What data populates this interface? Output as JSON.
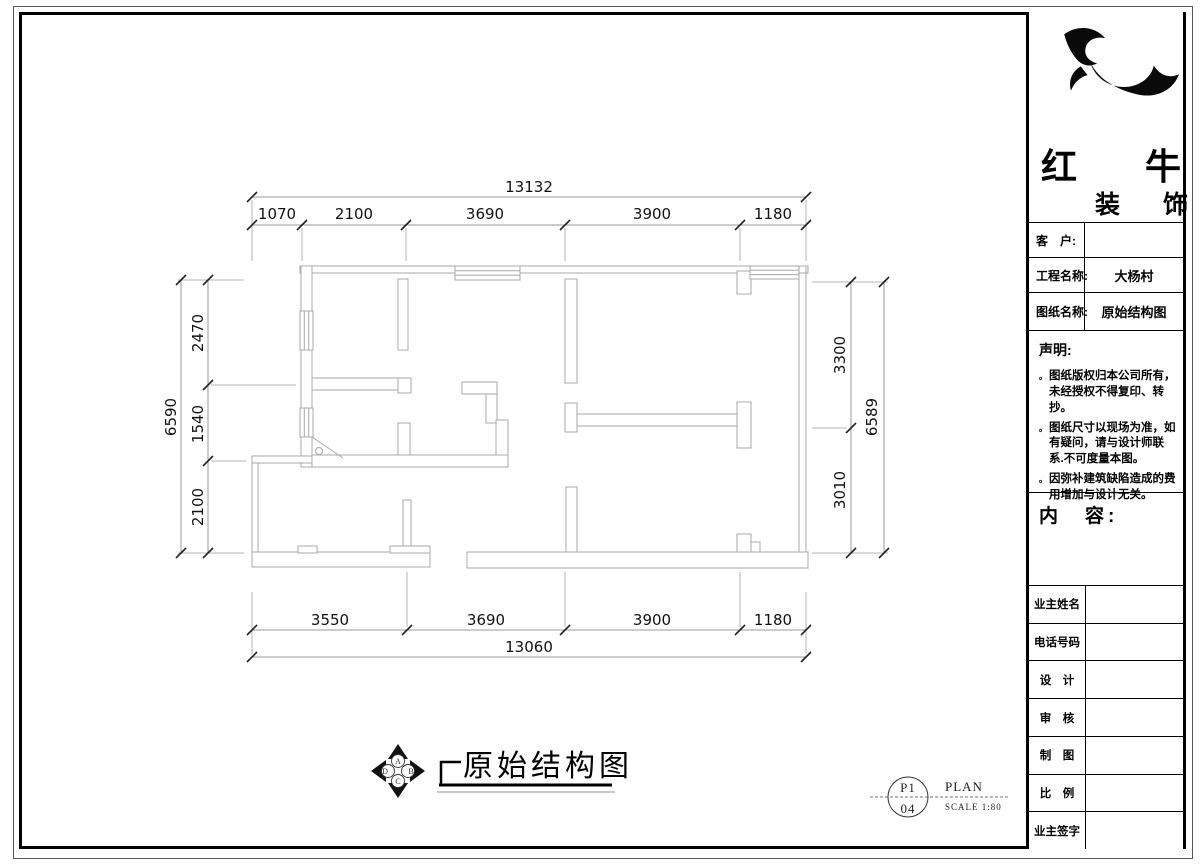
{
  "title_block": {
    "brand": {
      "name_top": "红　牛",
      "name_bottom": "装　饰"
    },
    "fields": [
      {
        "label": "客　户:",
        "value": ""
      },
      {
        "label": "工程名称:",
        "value": "大杨村"
      },
      {
        "label": "图纸名称:",
        "value": "原始结构图"
      }
    ],
    "statement": {
      "heading": "声明:",
      "bullet": "。",
      "items": [
        "图纸版权归本公司所有，未经授权不得复印、转抄。",
        "图纸尺寸以现场为准，如有疑问，请与设计师联系.不可度量本图。",
        "因弥补建筑缺陷造成的费用增加与设计无关。"
      ]
    },
    "content_heading": "内　容:",
    "sign_rows": [
      {
        "label": "业主姓名"
      },
      {
        "label": "电话号码"
      },
      {
        "label": "设　计"
      },
      {
        "label": "审　核"
      },
      {
        "label": "制　图"
      },
      {
        "label": "比　例"
      },
      {
        "label": "业主签字"
      }
    ]
  },
  "drawing": {
    "title": "原始结构图",
    "sheet": {
      "code_top": "P1",
      "code_bottom": "04",
      "type": "PLAN",
      "scale": "SCALE 1:80"
    },
    "compass": {
      "letters": [
        "A",
        "B",
        "C",
        "D"
      ]
    },
    "dimensions": {
      "top_total": "13132",
      "top_segments": [
        "1070",
        "2100",
        "3690",
        "3900",
        "1180"
      ],
      "left_total": "6590",
      "left_segments": [
        "2470",
        "1540",
        "2100"
      ],
      "right_total": "6589",
      "right_segments": [
        "3300",
        "3010"
      ],
      "bottom_segments": [
        "3550",
        "3690",
        "3900",
        "1180"
      ],
      "bottom_total": "13060"
    }
  }
}
